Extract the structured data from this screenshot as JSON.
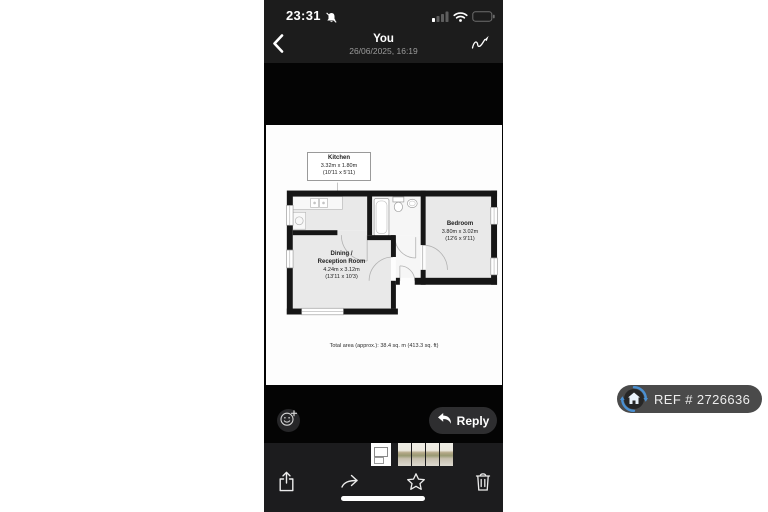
{
  "status_bar": {
    "time": "23:31"
  },
  "header": {
    "title": "You",
    "subtitle": "26/06/2025, 16:19"
  },
  "floorplan": {
    "kitchen": {
      "name": "Kitchen",
      "metric": "3.32m x 1.80m",
      "imperial": "(10'11 x 5'11)"
    },
    "dining": {
      "name": "Dining /\nReception Room",
      "metric": "4.24m x 3.12m",
      "imperial": "(13'11 x 10'3)"
    },
    "bedroom": {
      "name": "Bedroom",
      "metric": "3.80m x 3.02m",
      "imperial": "(12'6 x 9'11)"
    },
    "total_area": "Total area (approx.): 38.4 sq. m (413.3 sq. ft)"
  },
  "actions": {
    "reply_label": "Reply"
  },
  "ref_badge": {
    "label": "REF # 2726636",
    "accent": "#4a90d2",
    "bg": "#4a4a4a"
  },
  "thumbnails": {
    "count": 5,
    "types": [
      "floorplan",
      "photo",
      "photo",
      "photo",
      "photo"
    ]
  },
  "icons": {
    "status_left": "bell-slash",
    "status_right": [
      "cellular-signal-1of4",
      "wifi",
      "battery-empty"
    ],
    "header": [
      "chevron-left",
      "scribble-markup"
    ],
    "actions": [
      "smiley-plus",
      "reply-arrow"
    ],
    "toolbar": [
      "share-square-arrow-up",
      "forward-curved-arrow",
      "star-outline",
      "trash-can"
    ],
    "ref": "house-in-circular-arrows"
  },
  "colors": {
    "phone_bg": "#040404",
    "bar_bg": "#1c1c1e",
    "reply_bg": "#2e2e30",
    "photo_bg": "#fdfdfd"
  }
}
